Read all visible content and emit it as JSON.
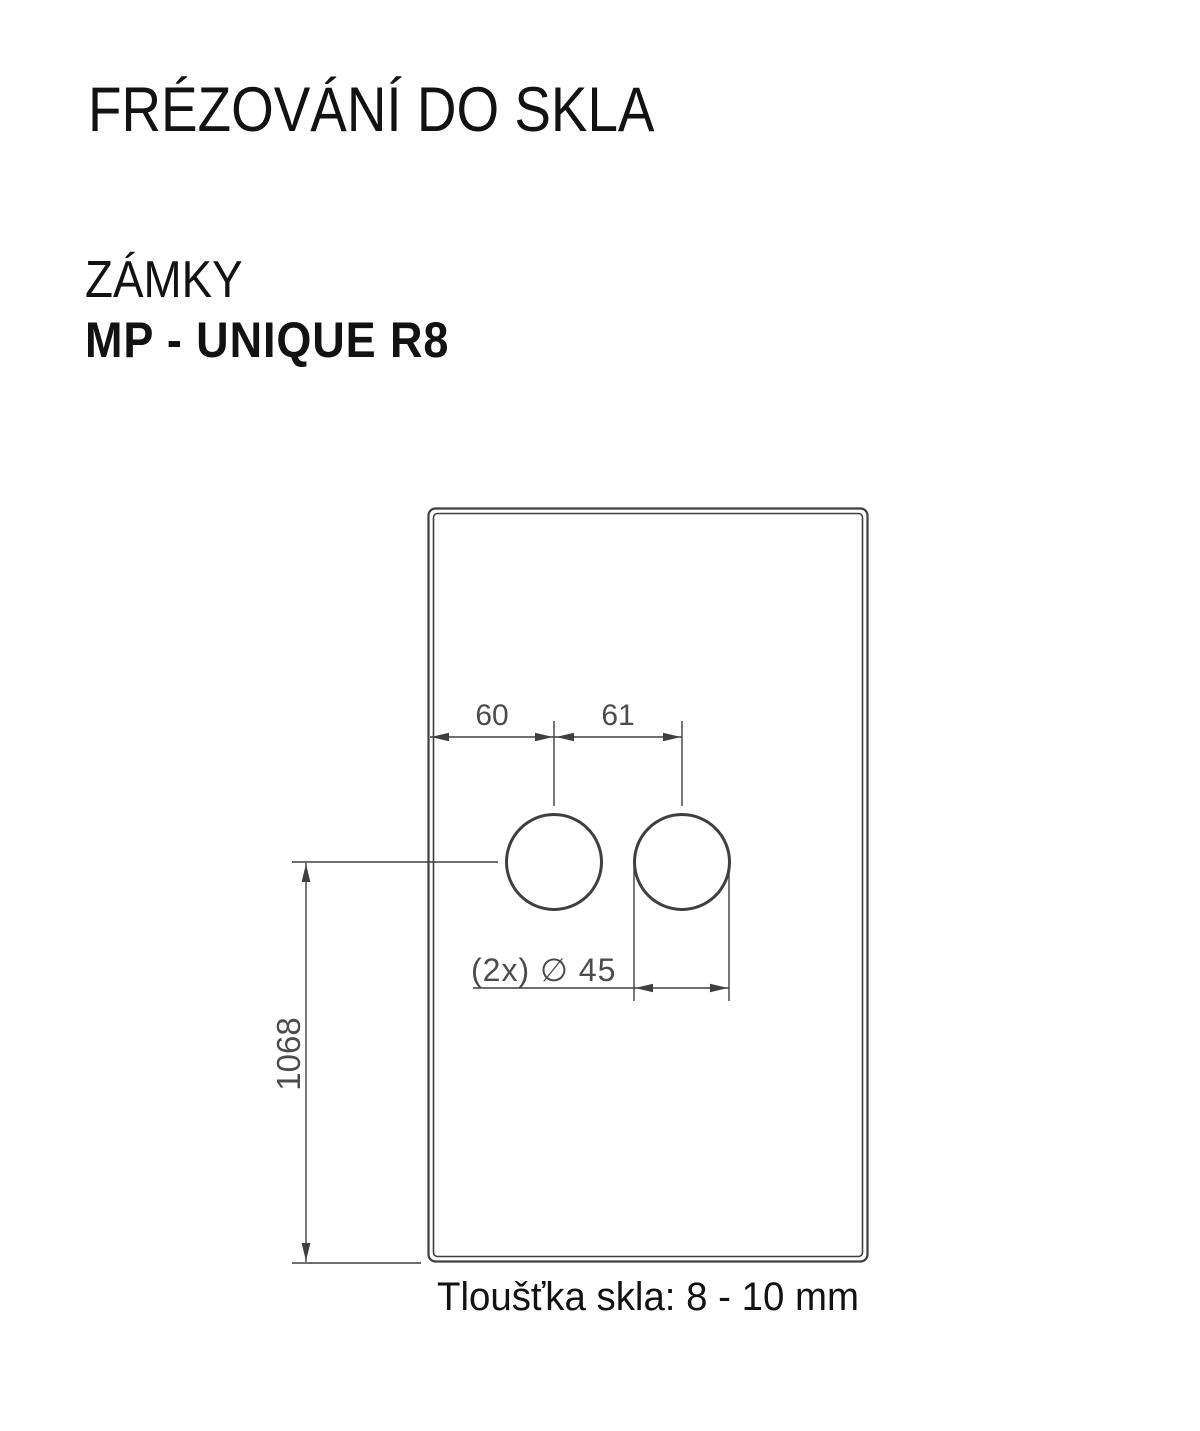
{
  "header": {
    "title": "FRÉZOVÁNÍ DO SKLA",
    "category": "ZÁMKY",
    "product": "MP - UNIQUE R8"
  },
  "drawing": {
    "dims": {
      "edge_to_first_hole_mm": "60",
      "hole_center_spacing_mm": "61",
      "hole_center_to_bottom_mm": "1068",
      "hole_diameter_label": "(2x) ∅ 45"
    },
    "glass_thickness_note": "Tloušťka skla: 8 - 10 mm",
    "colors": {
      "drawing_line": "#3f3f3f",
      "dimension_text": "#4c4c4c",
      "heading_text": "#121212"
    }
  }
}
